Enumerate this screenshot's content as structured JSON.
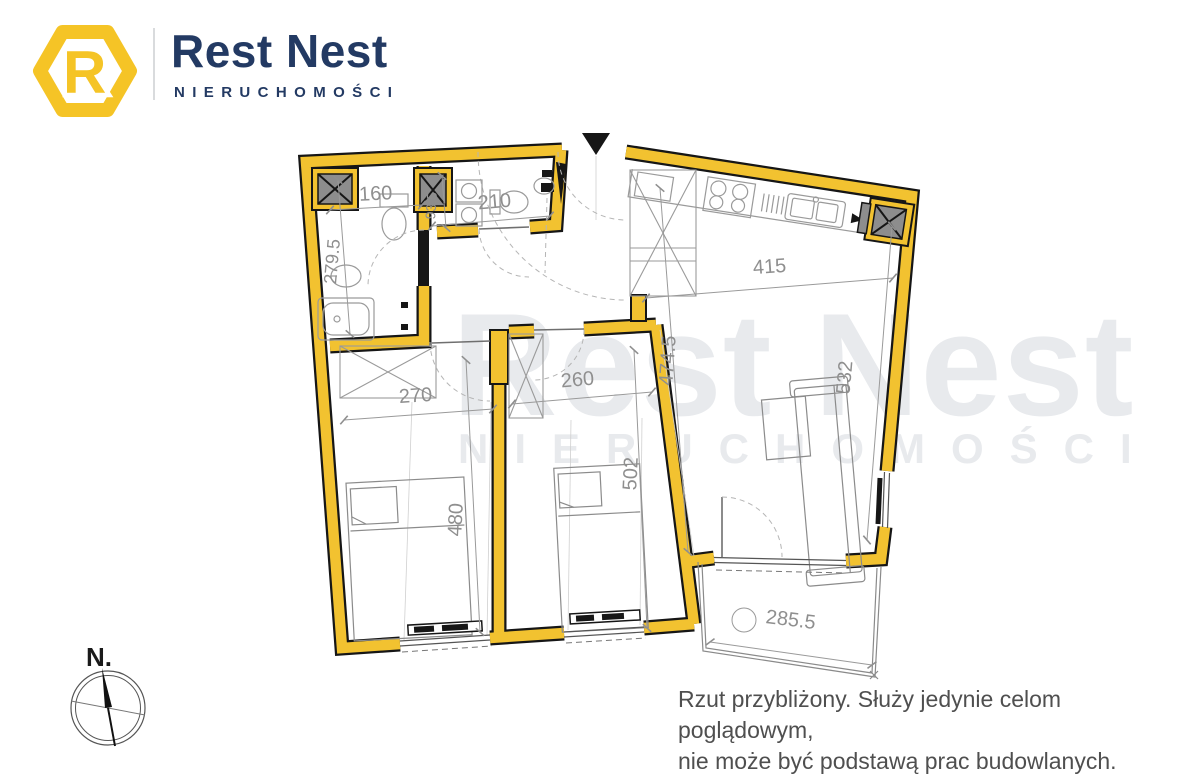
{
  "header": {
    "brand_name": "Rest Nest",
    "brand_subtitle": "NIERUCHOMOŚCI",
    "logo_letter": "R"
  },
  "watermark": {
    "title": "Rest Nest",
    "subtitle": "NIERUCHOMOŚCI"
  },
  "compass": {
    "north_label": "N."
  },
  "disclaimer": {
    "line1": "Rzut przybliżony. Służy jedynie celom poglądowym,",
    "line2": "nie może być podstawą prac budowlanych."
  },
  "floorplan": {
    "dims": {
      "d160": "160",
      "d93_5": "93.5",
      "d210": "210",
      "d279_5": "279.5",
      "d270": "270",
      "d260": "260",
      "d415": "415",
      "d474_5": "474.5",
      "d480": "480",
      "d502": "502",
      "d532": "532",
      "d285_5": "285.5"
    },
    "colors": {
      "wall_yellow": "#F2C230",
      "navy": "#233A63",
      "dim_gray": "#8f8f8f",
      "watermark_gray": "#E8EAED",
      "shaft_gray": "#8d8d8d"
    }
  }
}
